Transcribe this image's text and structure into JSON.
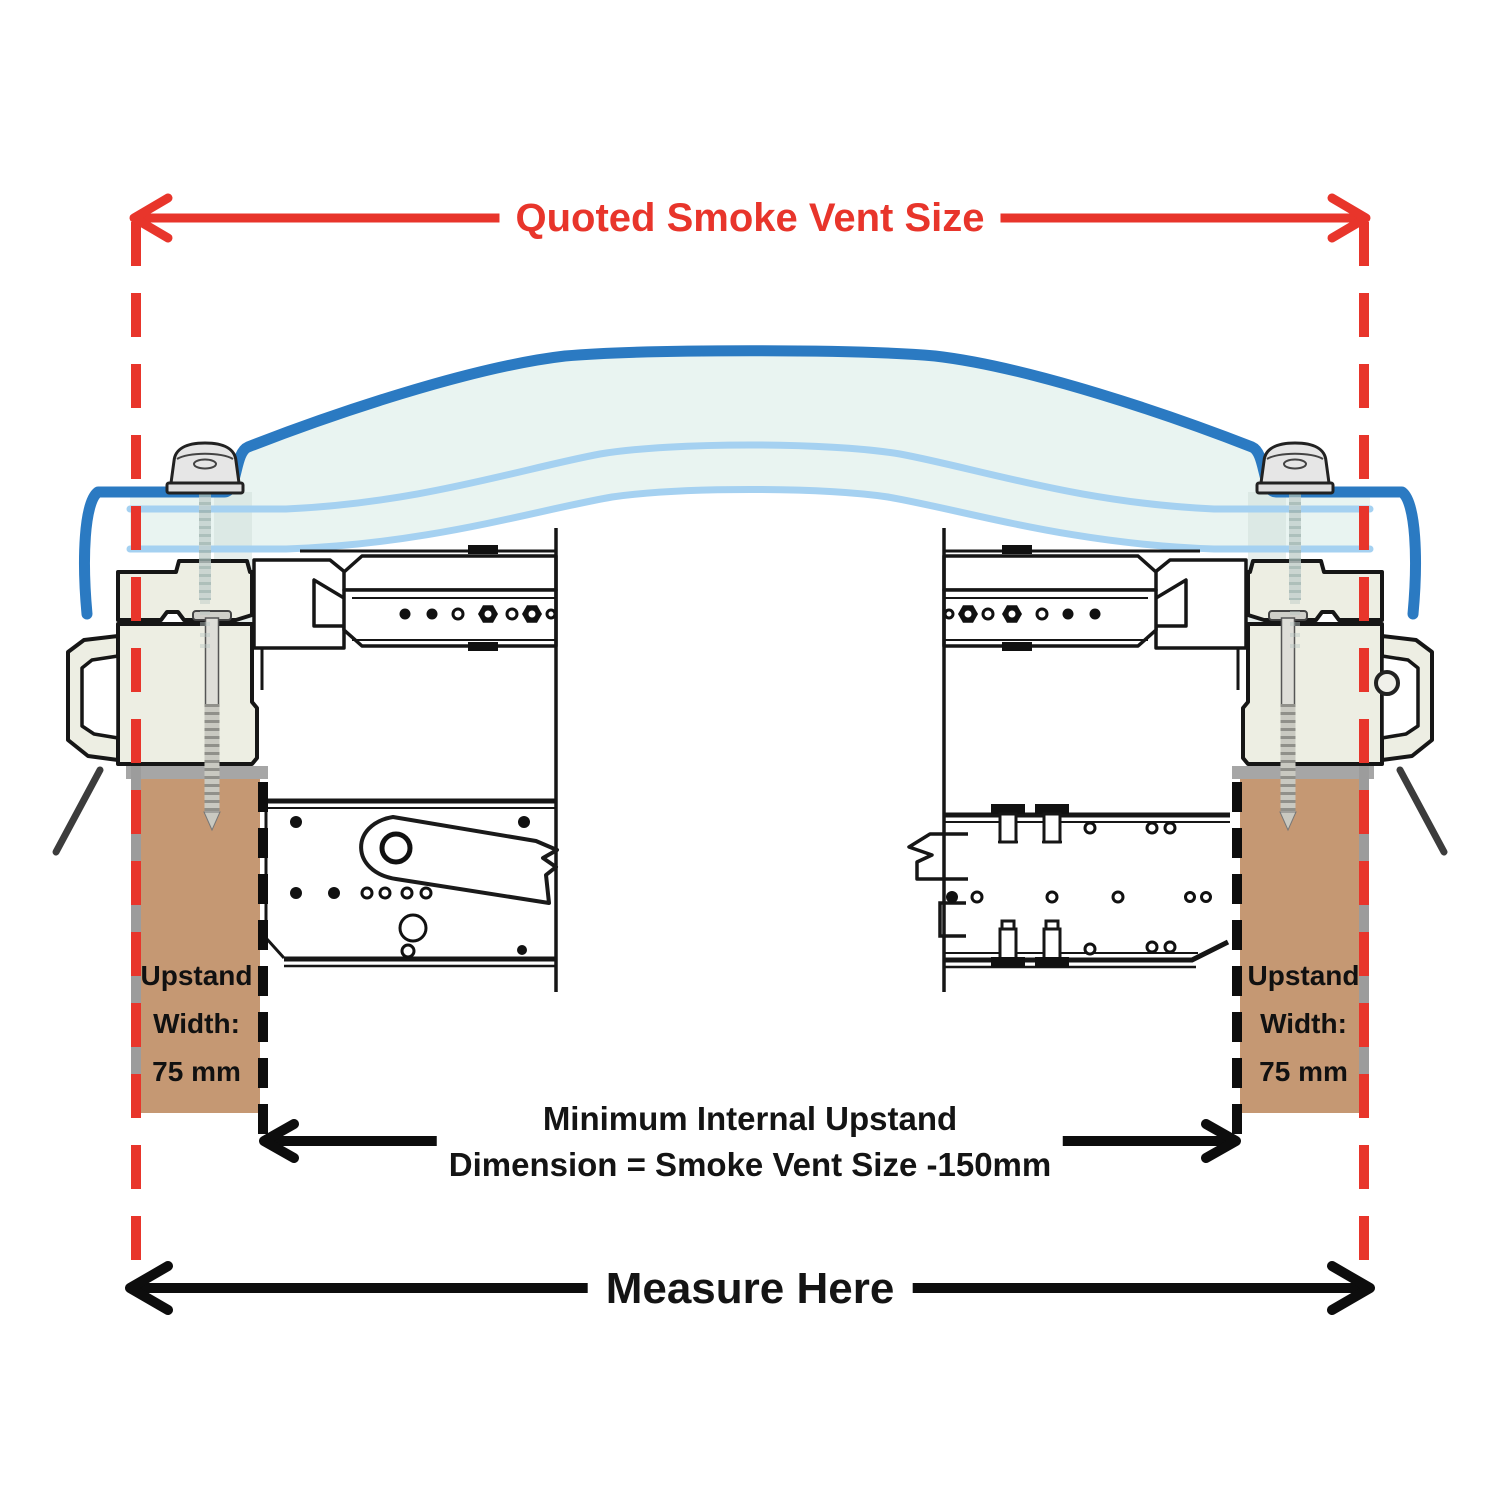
{
  "colors": {
    "red": "#e8352b",
    "blue-dark": "#2b7ac2",
    "blue-light": "#a5d1f1",
    "dome-fill": "#e9f4f1",
    "brown": "#c59873",
    "cream": "#edeee3",
    "grey-band": "#a6a6a6",
    "ink": "#141414"
  },
  "labels": {
    "top_dimension": "Quoted Smoke Vent Size",
    "internal_dimension_line1": "Minimum Internal Upstand",
    "internal_dimension_line2": "Dimension = Smoke Vent Size -150mm",
    "bottom_dimension": "Measure Here",
    "upstand_left": {
      "line1": "Upstand",
      "line2": "Width:",
      "line3": "75 mm"
    },
    "upstand_right": {
      "line1": "Upstand",
      "line2": "Width:",
      "line3": "75 mm"
    }
  }
}
